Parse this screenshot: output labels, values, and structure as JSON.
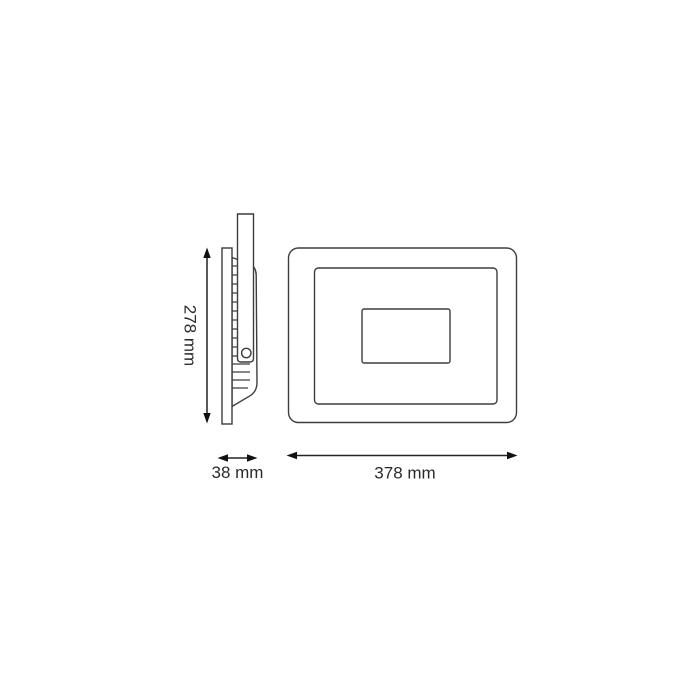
{
  "diagram": {
    "type": "product-dimension-drawing",
    "subject": "LED floodlight, side view and front view",
    "dimensions": {
      "height": {
        "text": "278 mm",
        "value": 278,
        "unit": "mm",
        "orientation": "vertical"
      },
      "depth": {
        "text": "38 mm",
        "value": 38,
        "unit": "mm",
        "orientation": "horizontal"
      },
      "width": {
        "text": "378 mm",
        "value": 378,
        "unit": "mm",
        "orientation": "horizontal"
      }
    },
    "colors": {
      "background": "#ffffff",
      "line": "#3d3d3d",
      "dimension_line": "#222222",
      "text": "#2a2a2a"
    }
  }
}
